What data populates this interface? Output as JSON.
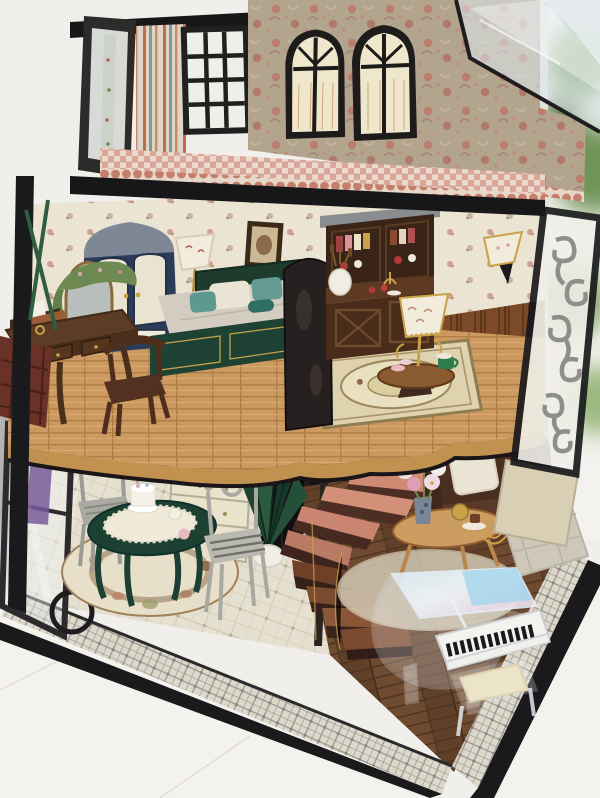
{
  "scene": {
    "description": "Photograph of a handcrafted three-story miniature dollhouse standing on a white table beside a bright window with green foliage outside.",
    "environment": "white tabletop, pale wall at left with a grey cushion, daylight window at right",
    "rooms": {
      "attic_balcony": "open balcony with striped wall, black lattice window, open glazed door, pink gingham floor with scalloped trim, damask wallpaper wall with two black arched windows, clear acrylic roof panel",
      "bedroom": "cream floral wallpaper, navy wardrobe with cream doors, floor lamp, framed picture, green-framed bed with beige duvet and teal pillows, dark wood desk with typewriter and draped mirror, wooden chair, red lattice screen",
      "parlor": "walnut hutch with dishes and wine rack, cattail vase, gold table lamp with floral shade on pedestal table, ornate square rug, brown wainscot wall, white wall sconce, dark arched divider",
      "dining_room": "glass corner walls, green dining table with cake and tea set, two grey chairs, round floral rug, cream cabinet with silver stove, dark doorway, diamond tile floor",
      "living_room": "sage damask wall, brown leather sofa with cream pillow, oval coffee table with pink flower vase and gold teapot, woven rugs, clear acrylic grand piano with bench, walnut plank floor",
      "staircase": "spiral staircase with salmon-pink upper treads and dark brown lower treads around a centre pole, paper fan plants in a white pot"
    },
    "objects": {
      "arched_window": "black arched window with cream glass",
      "lattice_window": "black 3x4 lattice casement window",
      "balcony_door": "open glazed balcony door",
      "acrylic_roof": "transparent acrylic roof sheet",
      "wardrobe": "navy wardrobe",
      "bed": "green bed with beige duvet",
      "desk": "dark wood writing desk",
      "typewriter": "copper typewriter",
      "desk_chair": "dark wood chair",
      "floor_lamp": "floor lamp with cream shade",
      "hutch": "walnut china hutch",
      "table_lamp": "gold lamp with floral shade",
      "sconce": "white wall sconce",
      "scroll_panel": "grey wrought-scroll side panel",
      "dining_table": "green dining table with cake",
      "dining_chairs": "grey dining chairs",
      "cabinet": "cream kitchen cabinet with stove",
      "spiral_staircase": "pink and brown spiral staircase",
      "sofa": "brown leather sofa",
      "coffee_table": "oval coffee table with flowers",
      "grand_piano": "clear acrylic grand piano",
      "piano_bench": "clear bench with cream cushion"
    }
  },
  "colors": {
    "background": "#f0efec",
    "tableSurface": "#f4f2ec",
    "frameBlack": "#1a1a1d",
    "wallpaperBase": "#b3a48d",
    "bedroomWall": "#ece4d2",
    "balconyBeam": "#17171a",
    "navyWardrobe": "#2b3b58",
    "wardrobeDoor": "#e9e3d1",
    "bedGreen": "#1e4233",
    "duvet": "#d3ccc0",
    "tealPillow": "#5f988f",
    "creamPillow": "#eae4d4",
    "deskWood": "#5d3c26",
    "chairWood": "#53301f",
    "hutchWood": "#4a2c1a",
    "lampShade": "#f2ecdc",
    "goldAccent": "#c9a24a",
    "wainscot": "#7c4a28",
    "dividerDark": "#262120",
    "sofaBrown": "#4a2f20",
    "sofaSeat": "#5a392a",
    "diningGreen": "#1c4133",
    "chairGray": "#aaaaa2",
    "cabinetCream": "#e9e3cb",
    "stoveSilver": "#b9bdc0",
    "stairPink": "#d08a74",
    "stairBrown": "#6e4028",
    "plantGreen": "#1f4430",
    "pianoLidBlue": "#9fd4ee",
    "benchCushion": "#ece4c8",
    "rugCream": "#e7dfc9",
    "cushionGray": "#b5b3b2",
    "foliageGreen": "#7fa065",
    "screenRed": "#6a3126",
    "sidePanelBeige": "#d8cfb4"
  }
}
